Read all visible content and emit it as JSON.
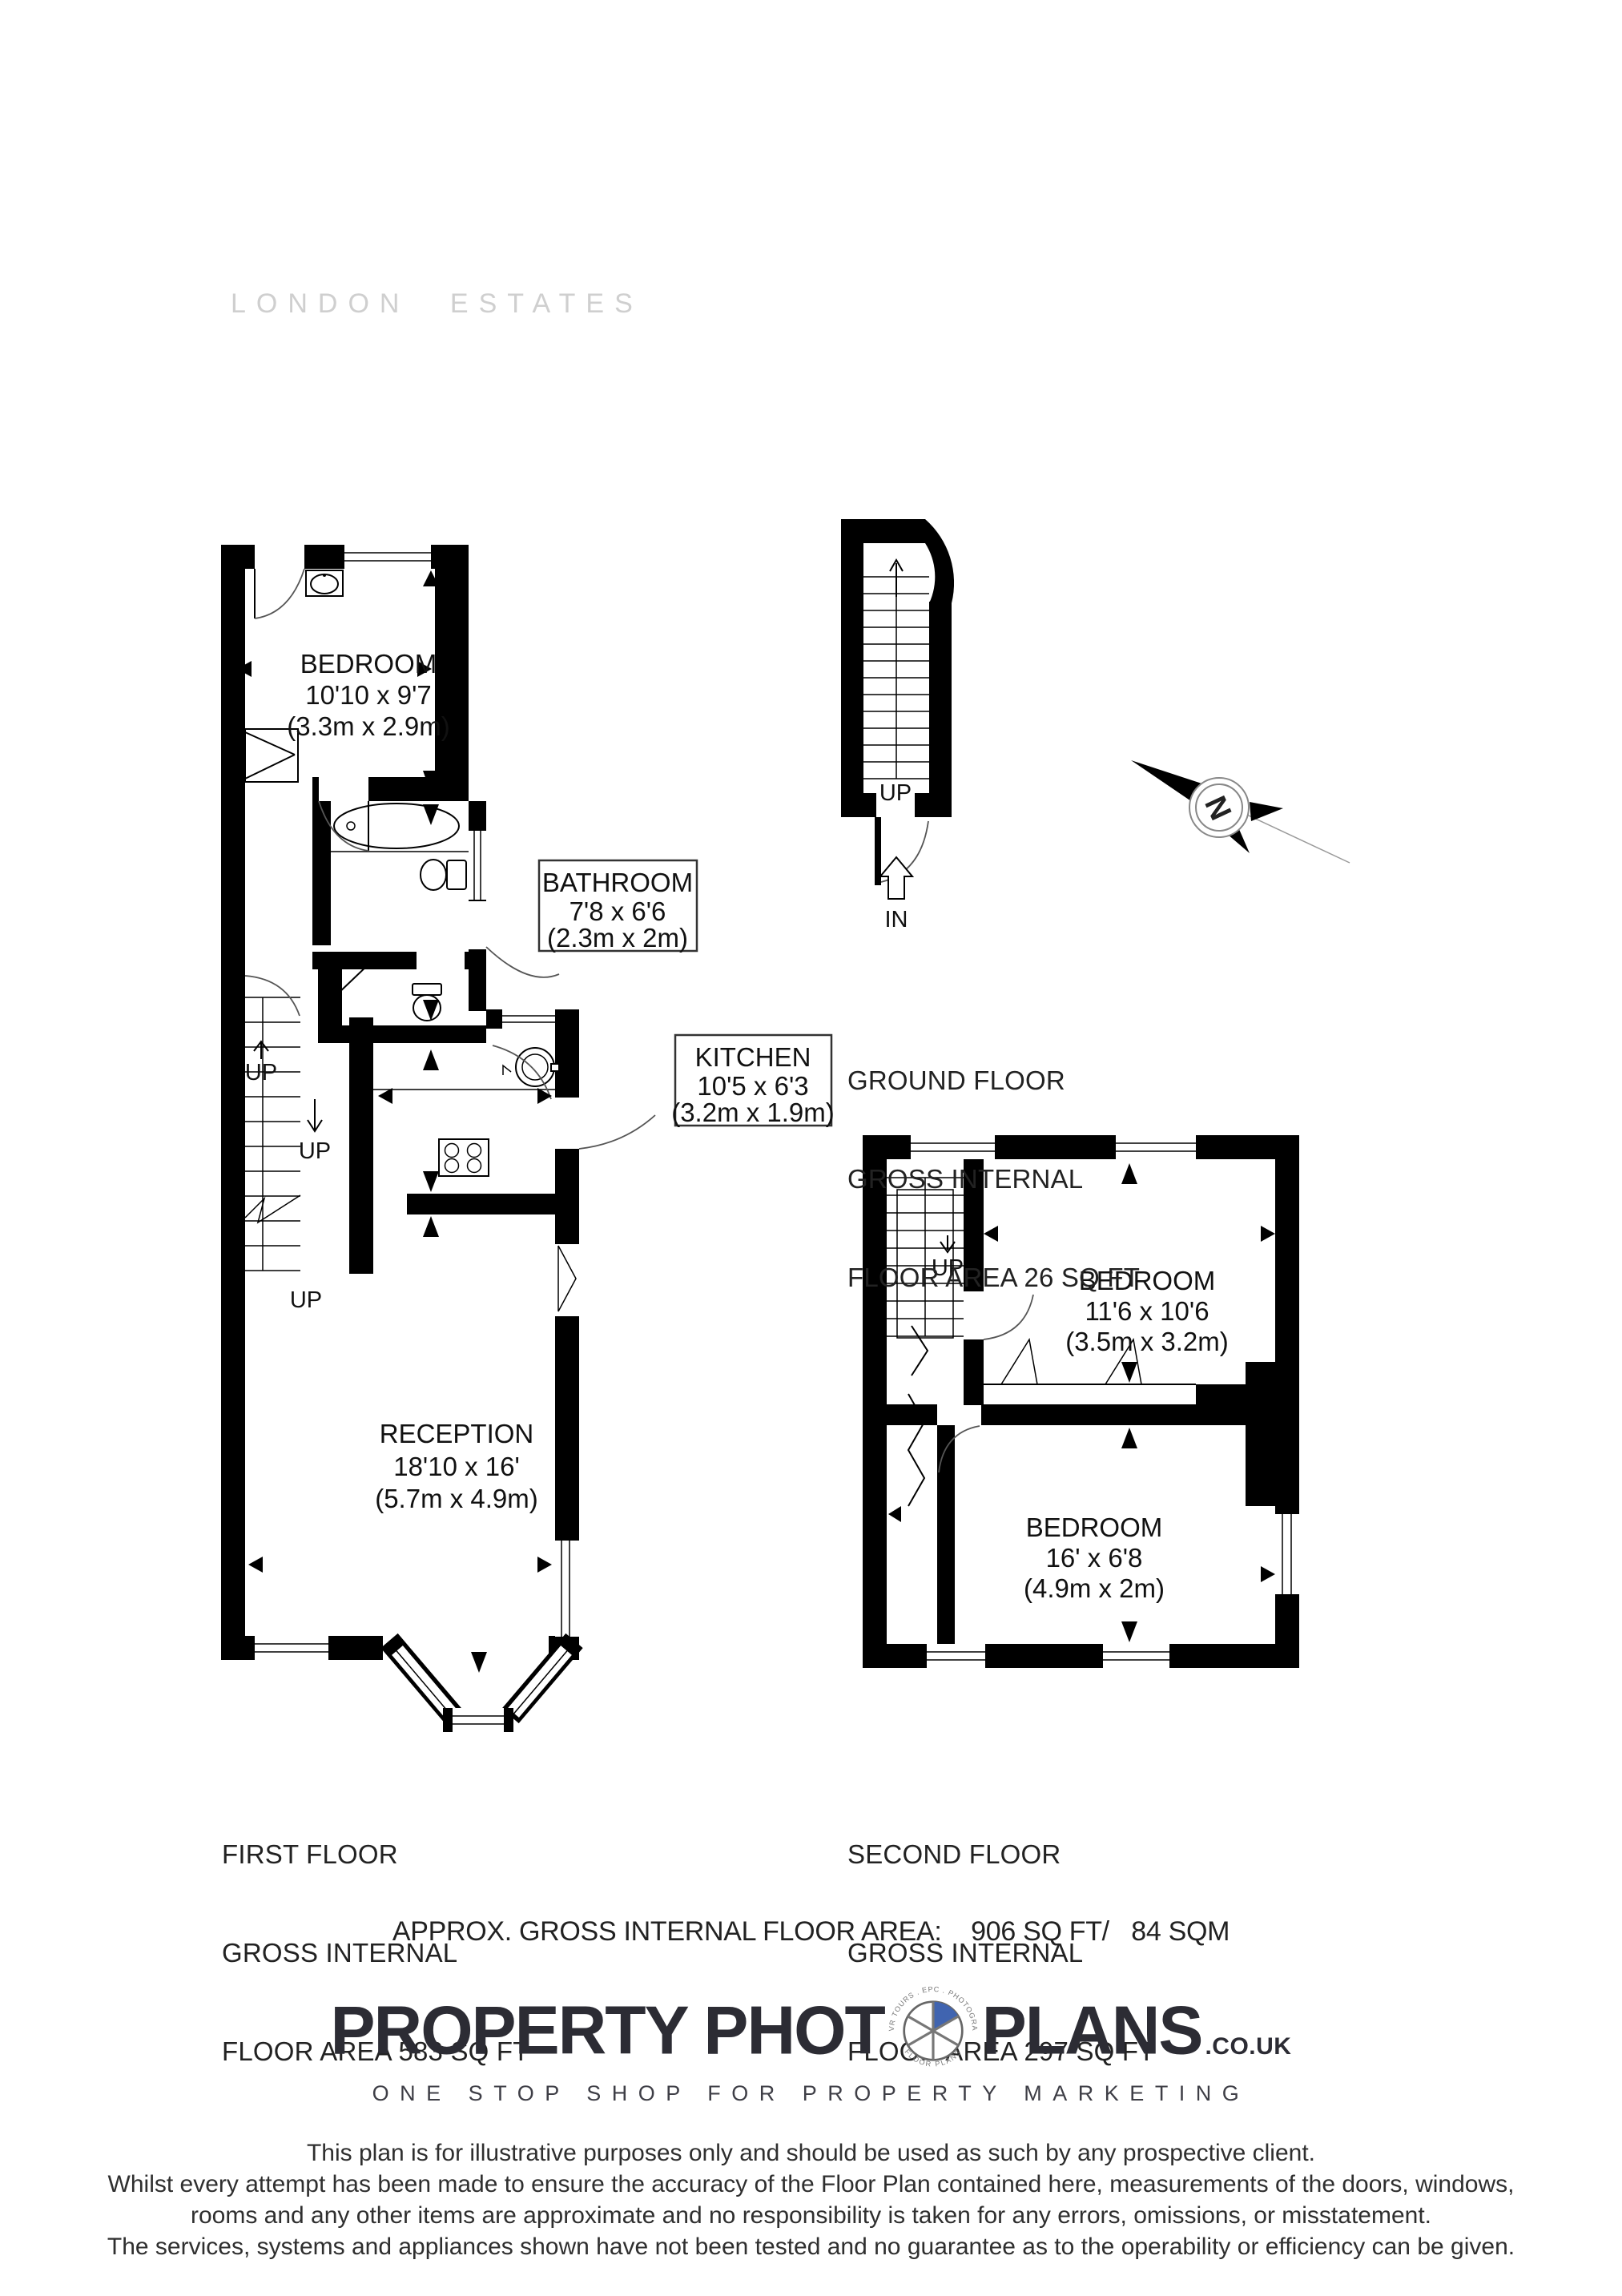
{
  "agency_logo": "LONDON ESTATES",
  "compass": {
    "north": "N"
  },
  "ground_floor": {
    "up": "UP",
    "entry": "IN",
    "title": {
      "l1": "GROUND FLOOR",
      "l2": "GROSS INTERNAL",
      "l3": "FLOOR AREA 26 SQ FT"
    }
  },
  "first_floor": {
    "up1": "UP",
    "up2": "UP",
    "up3": "UP",
    "rooms": {
      "bedroom": {
        "name": "BEDROOM",
        "size_ft": "10'10 x 9'7",
        "size_m": "(3.3m x 2.9m)"
      },
      "bathroom": {
        "name": "BATHROOM",
        "size_ft": "7'8 x 6'6",
        "size_m": "(2.3m x 2m)"
      },
      "kitchen": {
        "name": "KITCHEN",
        "size_ft": "10'5 x 6'3",
        "size_m": "(3.2m x 1.9m)"
      },
      "reception": {
        "name": "RECEPTION",
        "size_ft": "18'10 x 16'",
        "size_m": "(5.7m x 4.9m)"
      }
    },
    "title": {
      "l1": "FIRST FLOOR",
      "l2": "GROSS INTERNAL",
      "l3": "FLOOR AREA 583 SQ FT"
    }
  },
  "second_floor": {
    "up": "UP",
    "rooms": {
      "bedroom1": {
        "name": "BEDROOM",
        "size_ft": "11'6 x 10'6",
        "size_m": "(3.5m x 3.2m)"
      },
      "bedroom2": {
        "name": "BEDROOM",
        "size_ft": "16' x 6'8",
        "size_m": "(4.9m x 2m)"
      }
    },
    "title": {
      "l1": "SECOND FLOOR",
      "l2": "GROSS INTERNAL",
      "l3": "FLOOR AREA 297 SQ FT"
    }
  },
  "summary": "APPROX. GROSS INTERNAL FLOOR AREA:    906 SQ FT/   84 SQM",
  "brand": {
    "word1": "PROPERTY PHOT",
    "word2": "PLANS",
    "suffix": ".CO.UK",
    "ring_top": "360 VR TOURS . EPC . PHOTOGRAPHY",
    "ring_bottom": "FLOOR PLANS",
    "tagline": "ONE STOP SHOP FOR PROPERTY MARKETING",
    "accent_color": "#4064b0"
  },
  "disclaimer": {
    "l1": "This plan is for illustrative purposes only and should be used as such by any prospective client.",
    "l2": "Whilst every attempt has been made to ensure the accuracy of the Floor Plan contained here, measurements of the doors, windows,",
    "l3": "rooms and any other items are approximate and no responsibility is taken for any errors, omissions, or misstatement.",
    "l4": "The services, systems and appliances shown have not been tested and no guarantee as to the operability or efficiency can be given."
  }
}
